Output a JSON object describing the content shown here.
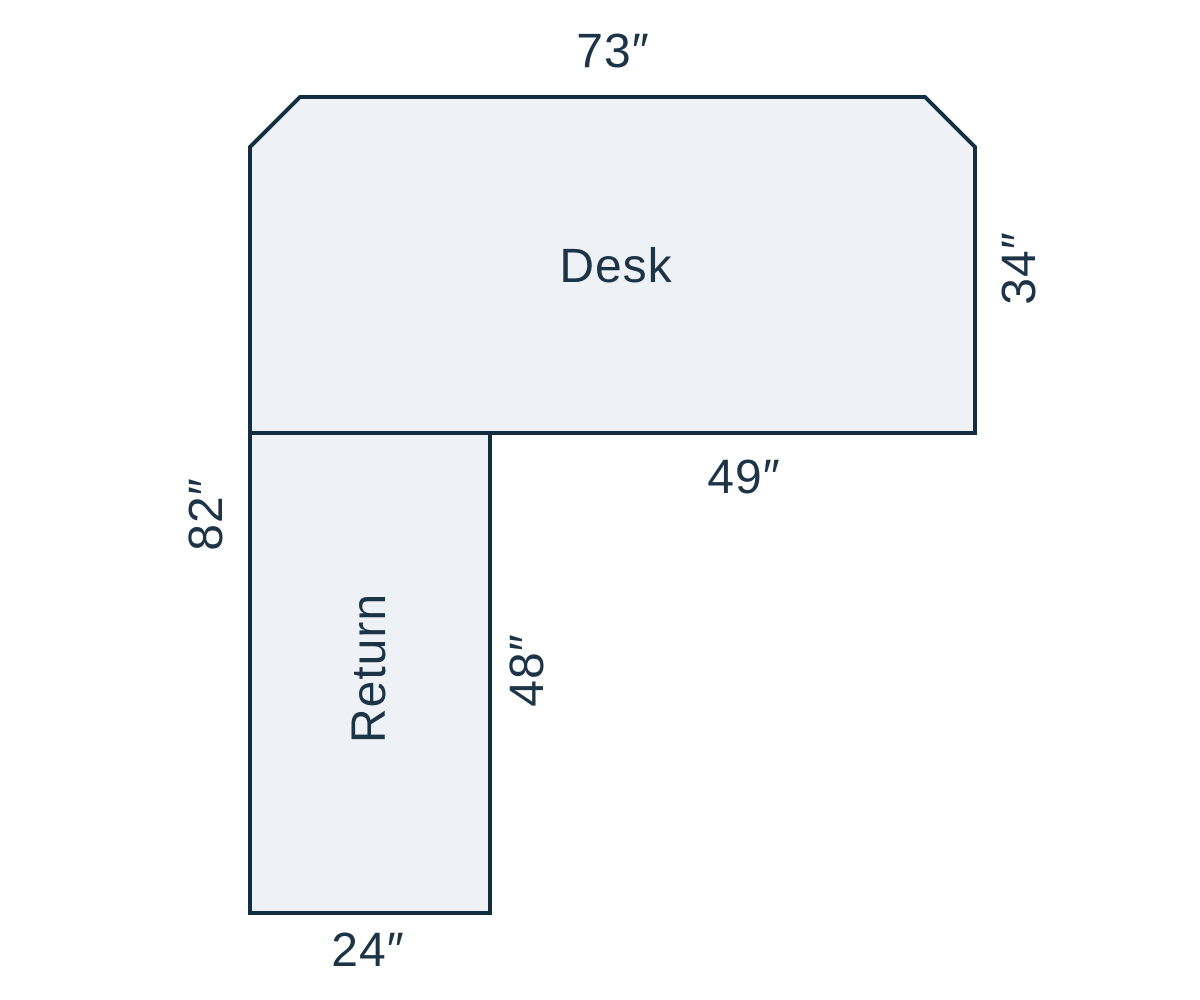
{
  "canvas": {
    "width": 1200,
    "height": 1000,
    "background": "#ffffff"
  },
  "colors": {
    "outline": "#122e40",
    "surface_fill": "#eef2f6",
    "text": "#1d3346"
  },
  "scale": "10px per inch",
  "desk": {
    "name": "Desk",
    "top_width": "73″",
    "right_depth": "34″",
    "bottom_right_span": "49″"
  },
  "return": {
    "name": "Return",
    "left_total_height": "82″",
    "right_inner_height": "48″",
    "bottom_width": "24″"
  }
}
